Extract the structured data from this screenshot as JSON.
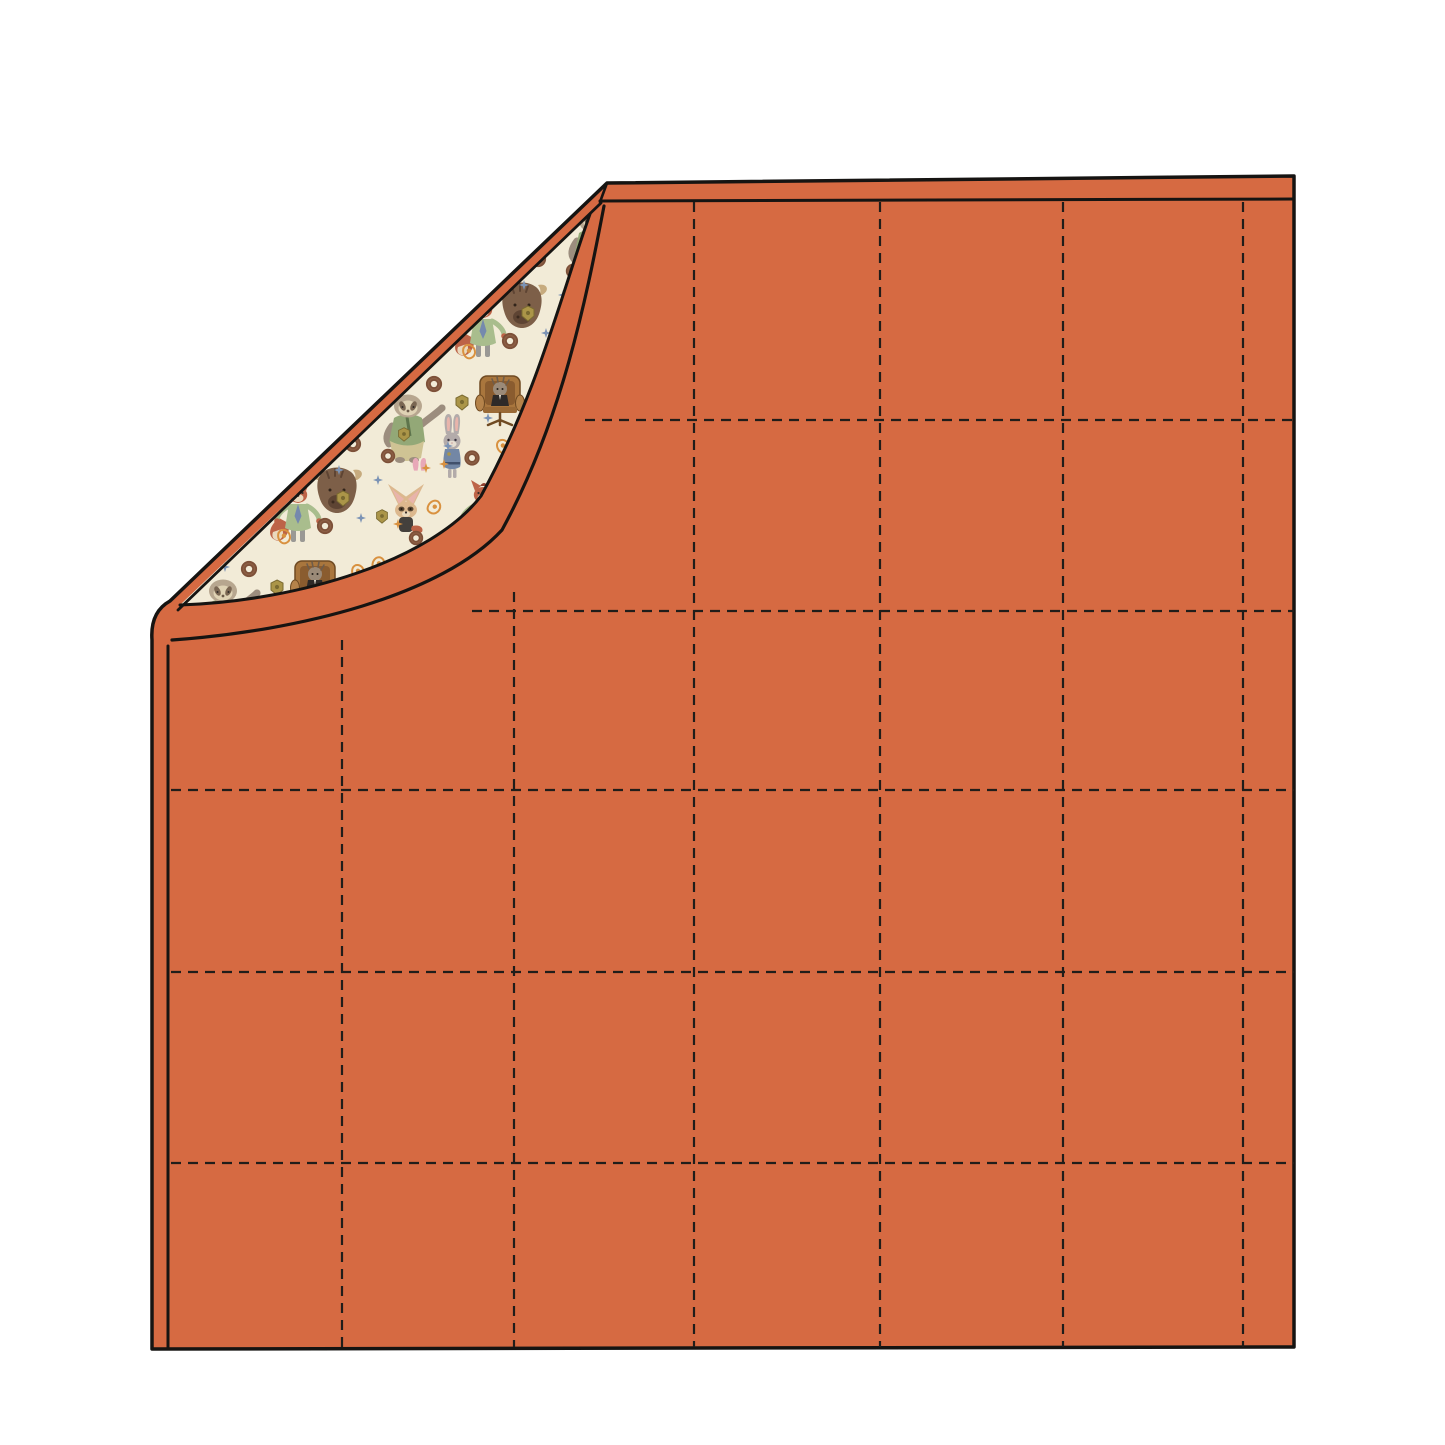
{
  "scene": {
    "description": "flat mockup illustration of an orange quilted blanket with its top-left corner folded over, revealing a cream cartoon-animal print lining",
    "canvas": {
      "width": 1445,
      "height": 1445,
      "background": "#ffffff"
    }
  },
  "colors": {
    "blanket_orange": "#d66a42",
    "outline_black": "#161412",
    "stitch_dark": "#201d1a",
    "lining_cream": "#f2ebd7",
    "sloth_fur": "#9c8d7e",
    "sloth_head": "#b7a68f",
    "sloth_face": "#dfd2b4",
    "sloth_shirt": "#93a877",
    "sloth_pants": "#cfc394",
    "fox_fur": "#bd6347",
    "fox_shirt": "#a9bd8d",
    "fox_tie": "#7589ad",
    "rabbit_fur": "#b3abaa",
    "rabbit_uniform": "#7387a5",
    "fennec_fur": "#dcb88e",
    "fennec_shirt": "#44403c",
    "ear_pink": "#e8b4ab",
    "chair_brown": "#a9763d",
    "buffalo_brown": "#7d5f48",
    "donut_brown": "#7d5038",
    "badge_gold": "#ab9548",
    "paisley_orange": "#d9913f",
    "star_blue": "#7b93b5",
    "cream_tip": "#ead9bd"
  },
  "quilting_grid": {
    "dash": "10 7",
    "line_width": 2.2,
    "right_x": 1294,
    "bottom_y": 1347,
    "vertical_lines": [
      {
        "x": 342,
        "y1": 640
      },
      {
        "x": 514,
        "y1": 592
      },
      {
        "x": 694,
        "y1": 202
      },
      {
        "x": 880,
        "y1": 202
      },
      {
        "x": 1063,
        "y1": 202
      },
      {
        "x": 1243,
        "y1": 202
      }
    ],
    "horizontal_lines": [
      {
        "y": 420,
        "x1": 585
      },
      {
        "y": 611,
        "x1": 472
      },
      {
        "y": 790,
        "x1": 171
      },
      {
        "y": 972,
        "x1": 171
      },
      {
        "y": 1163,
        "x1": 171
      }
    ]
  },
  "lining_pattern_motifs": [
    "sloth-character",
    "armchair-boss-character",
    "buffalo-head-character",
    "fox-with-tie-character",
    "rabbit-officer-character",
    "fennec-fox-character",
    "meditating-creature-character",
    "donut",
    "police-badge",
    "paisley",
    "sparkle-star",
    "bunny-ears"
  ]
}
